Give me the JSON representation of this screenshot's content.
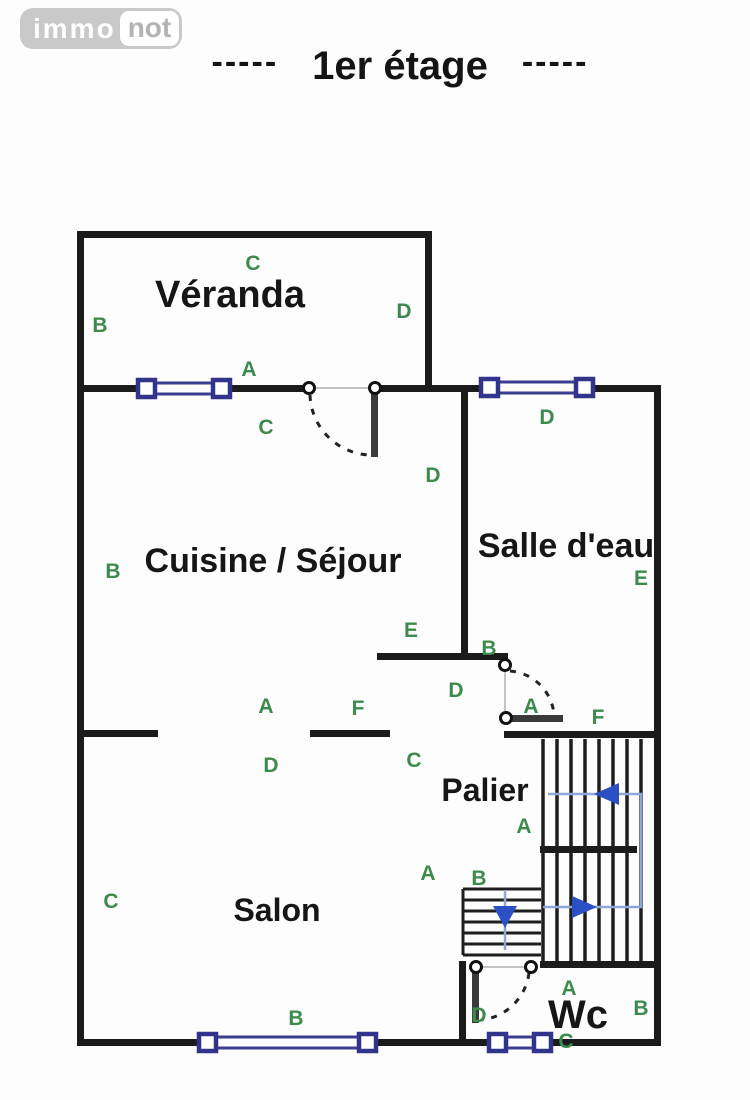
{
  "header": {
    "logo": {
      "text_primary": "immo",
      "text_secondary": "not"
    },
    "title": "----- 1er étage -----",
    "title_parts": {
      "left_dashes": "-----",
      "text": "1er étage",
      "right_dashes": "-----"
    }
  },
  "floor_plan": {
    "rooms": {
      "veranda": "Véranda",
      "cuisine_sejour": "Cuisine / Séjour",
      "salle_deau": "Salle d'eau",
      "palier": "Palier",
      "salon": "Salon",
      "wc": "Wc"
    },
    "zone_markers": [
      {
        "letter": "C",
        "x": 253,
        "y": 270
      },
      {
        "letter": "B",
        "x": 100,
        "y": 332
      },
      {
        "letter": "D",
        "x": 404,
        "y": 318
      },
      {
        "letter": "A",
        "x": 249,
        "y": 376
      },
      {
        "letter": "C",
        "x": 266,
        "y": 434
      },
      {
        "letter": "D",
        "x": 547,
        "y": 424
      },
      {
        "letter": "D",
        "x": 433,
        "y": 482
      },
      {
        "letter": "B",
        "x": 113,
        "y": 578
      },
      {
        "letter": "E",
        "x": 641,
        "y": 585
      },
      {
        "letter": "E",
        "x": 411,
        "y": 637
      },
      {
        "letter": "B",
        "x": 489,
        "y": 655
      },
      {
        "letter": "D",
        "x": 456,
        "y": 697
      },
      {
        "letter": "A",
        "x": 531,
        "y": 713
      },
      {
        "letter": "F",
        "x": 598,
        "y": 724
      },
      {
        "letter": "A",
        "x": 266,
        "y": 713
      },
      {
        "letter": "F",
        "x": 358,
        "y": 715
      },
      {
        "letter": "D",
        "x": 271,
        "y": 772
      },
      {
        "letter": "C",
        "x": 414,
        "y": 767
      },
      {
        "letter": "A",
        "x": 524,
        "y": 833
      },
      {
        "letter": "A",
        "x": 428,
        "y": 880
      },
      {
        "letter": "B",
        "x": 479,
        "y": 885
      },
      {
        "letter": "C",
        "x": 111,
        "y": 908
      },
      {
        "letter": "B",
        "x": 296,
        "y": 1025
      },
      {
        "letter": "A",
        "x": 569,
        "y": 995
      },
      {
        "letter": "B",
        "x": 641,
        "y": 1015
      },
      {
        "letter": "D",
        "x": 479,
        "y": 1022
      },
      {
        "letter": "C",
        "x": 566,
        "y": 1048
      }
    ],
    "symbols": {
      "windows": 4,
      "doors": 3,
      "staircase_note": "U-shaped staircase with up arrows and a lower flight with down arrow"
    },
    "colors": {
      "wall": "#1b1b1b",
      "window_frame": "#3b3d8e",
      "marker_green": "#3d8a4d",
      "stairs_arrow_blue": "#2b50c4",
      "logo_gray": "#c9c9c9",
      "background": "#fdfdfd"
    }
  }
}
